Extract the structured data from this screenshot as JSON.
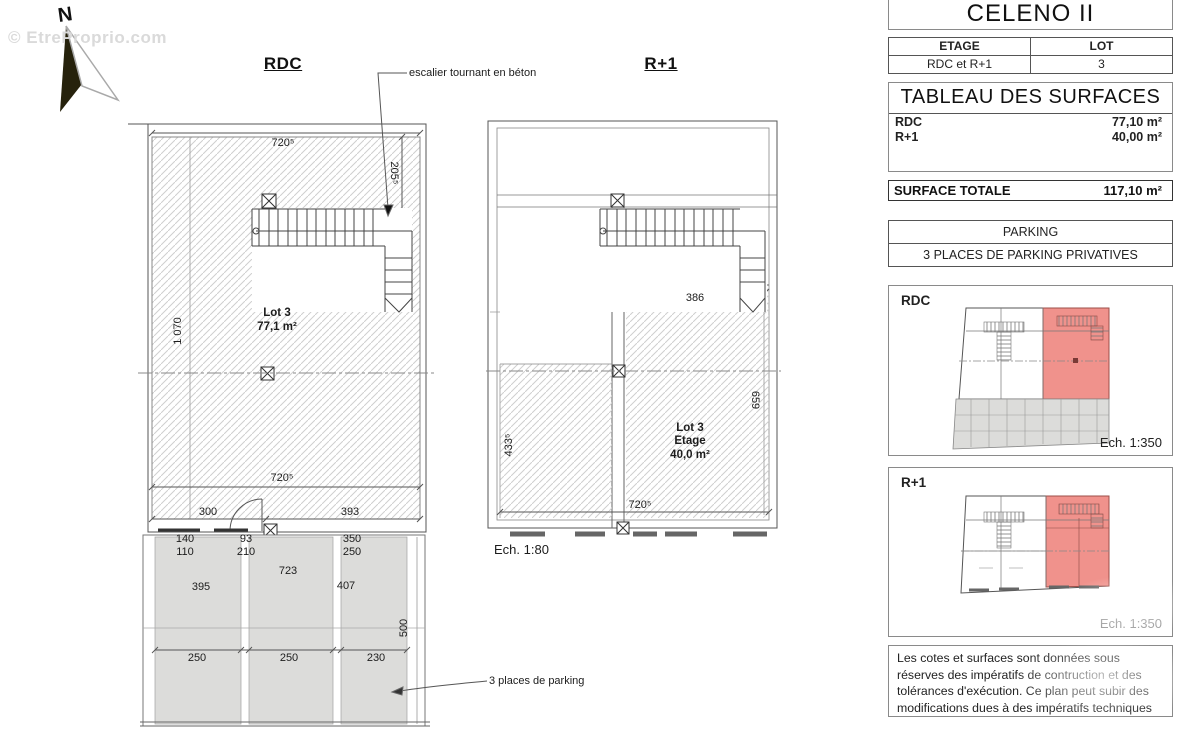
{
  "watermark": {
    "text": "© EtreProprio.com"
  },
  "compass": {
    "n": "N"
  },
  "rdc": {
    "title": "RDC",
    "stair_note": "escalier tournant en béton",
    "lot": {
      "name": "Lot 3",
      "area": "77,1 m²"
    },
    "dims": {
      "top": "720⁵",
      "right": "205⁵",
      "left": "1 070",
      "inner_bottom": "720⁵",
      "d300": "300",
      "d393": "393",
      "d140": "140",
      "d110": "110",
      "d93": "93",
      "d210": "210",
      "d350": "350",
      "d250": "250",
      "d723": "723",
      "d395": "395",
      "d407": "407",
      "s1": "250",
      "s2": "250",
      "s3": "230",
      "depth": "500"
    },
    "parking_note": "3 places de parking"
  },
  "r1": {
    "title": "R+1",
    "lot": {
      "name": "Lot 3",
      "floor": "Etage",
      "area": "40,0 m²"
    },
    "dims": {
      "top": "386",
      "left": "433⁵",
      "right": "659",
      "bottom": "720⁵"
    },
    "scale": "Ech. 1:80"
  },
  "panel": {
    "title": "CELENO II",
    "etage": {
      "h1": "ETAGE",
      "h2": "LOT",
      "v1": "RDC et R+1",
      "v2": "3"
    },
    "surfaces": {
      "title": "TABLEAU DES SURFACES",
      "rows": [
        {
          "label": "RDC",
          "value": "77,10 m²"
        },
        {
          "label": "R+1",
          "value": "40,00 m²"
        }
      ],
      "total_label": "SURFACE TOTALE",
      "total_value": "117,10 m²"
    },
    "parking": {
      "title": "PARKING",
      "value": "3 PLACES DE PARKING PRIVATIVES"
    },
    "mini_rdc": {
      "label": "RDC",
      "scale": "Ech. 1:350"
    },
    "mini_r1": {
      "label": "R+1",
      "scale": "Ech. 1:350"
    },
    "notes": "Les cotes et surfaces sont données sous réserves des impératifs de contruction et des tolérances d'exécution. Ce plan peut subir des modifications dues à des impératifs techniques"
  },
  "colors": {
    "highlight_red": "#f0928c",
    "parking_gray": "#dcdcda",
    "hatch_gray": "#cfcfcf",
    "wall": "#555555",
    "watermark_gray": "#dadada"
  }
}
